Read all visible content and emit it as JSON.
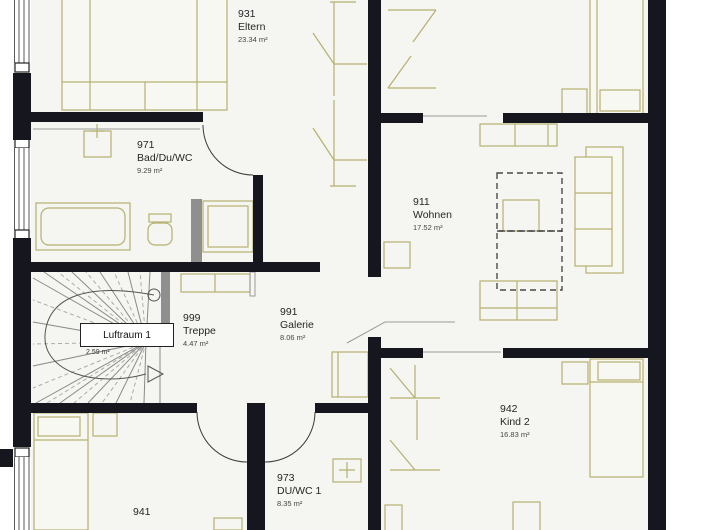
{
  "plan_title": "Obergeschoss Grundriss",
  "colors": {
    "wall": "#16161f",
    "furniture_outline": "#b6b170",
    "floor": "#f5f5f1",
    "void_dash": "#4a4a4a"
  },
  "rooms": [
    {
      "number": "931",
      "name": "Eltern",
      "area": "23.34 m²"
    },
    {
      "number": "971",
      "name": "Bad/Du/WC",
      "area": "9.29 m²"
    },
    {
      "number": "911",
      "name": "Wohnen",
      "area": "17.52 m²"
    },
    {
      "number": "999",
      "name": "Treppe",
      "area": "4.47 m²"
    },
    {
      "number": "991",
      "name": "Galerie",
      "area": "8.06 m²"
    },
    {
      "number": "942",
      "name": "Kind 2",
      "area": "16.83 m²"
    },
    {
      "number": "973",
      "name": "DU/WC 1",
      "area": "8.35 m²"
    },
    {
      "number": "941",
      "name": "",
      "area": ""
    }
  ],
  "void_label": {
    "name": "Luftraum 1",
    "area": "2.59 m²"
  }
}
